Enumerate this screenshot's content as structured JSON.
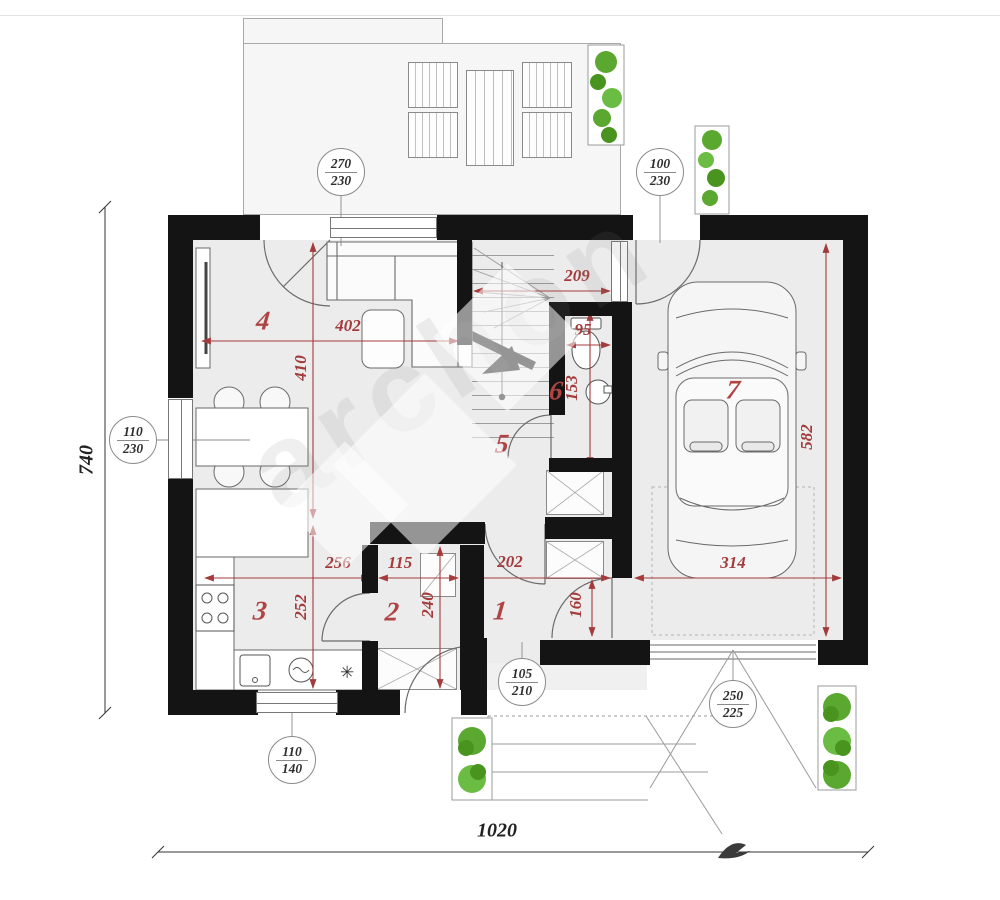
{
  "watermark": {
    "text": "archon"
  },
  "rooms": {
    "r1": "1",
    "r2": "2",
    "r3": "3",
    "r4": "4",
    "r5": "5",
    "r6": "6",
    "r7": "7"
  },
  "dims": {
    "living_width": "402",
    "living_depth": "410",
    "kitchen_depth": "252",
    "stair_hall_width": "209",
    "wc_width": "95",
    "wc_depth": "153",
    "garage_depth": "582",
    "kitchen_width": "256",
    "pantry_width": "115",
    "entry_hall_width": "202",
    "pantry_depth": "240",
    "garage_passage": "160",
    "garage_width": "314",
    "total_depth_left": "740",
    "total_width_bottom": "1020"
  },
  "opening_tags": {
    "terrace_window": {
      "width": "270",
      "height": "230"
    },
    "garage_side_door": {
      "width": "100",
      "height": "230"
    },
    "dining_window": {
      "width": "110",
      "height": "230"
    },
    "kitchen_window": {
      "width": "110",
      "height": "140"
    },
    "entry_door": {
      "width": "105",
      "height": "210"
    },
    "garage_gate": {
      "width": "250",
      "height": "225"
    }
  },
  "icons": {
    "appliance_asterisk": "✳"
  }
}
